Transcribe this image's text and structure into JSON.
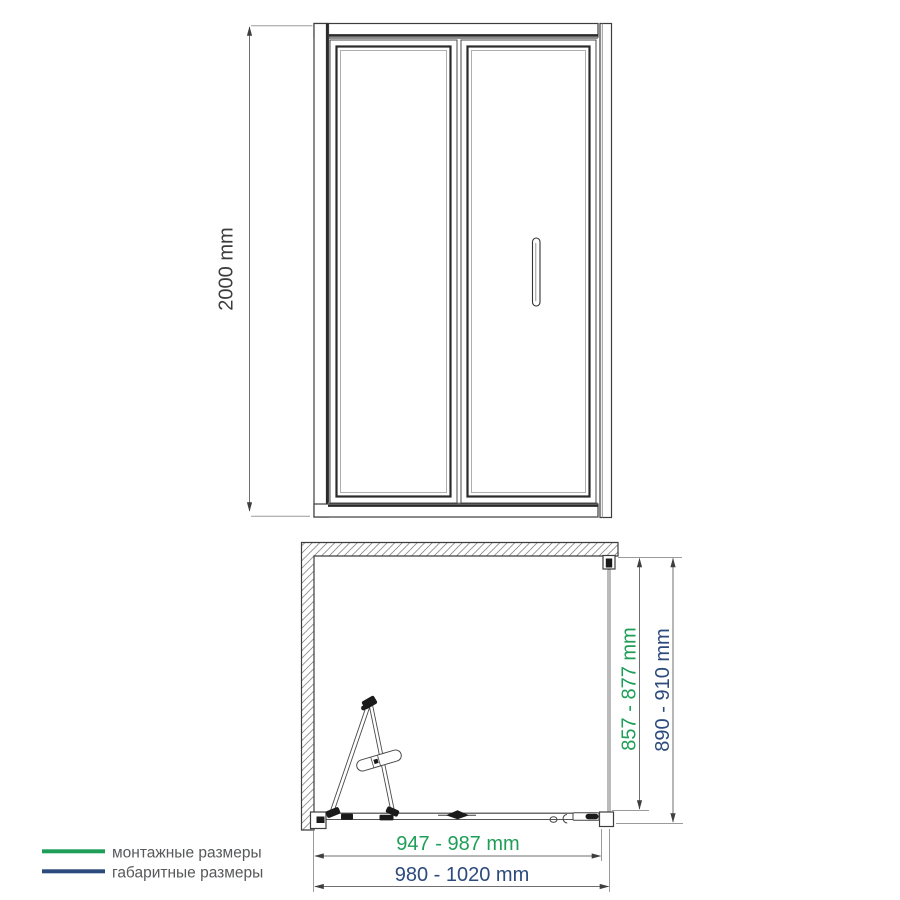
{
  "drawing": {
    "front_view": {
      "height": "2000 mm"
    },
    "plan_view": {
      "installation_depth": "857 - 877 mm",
      "overall_depth": "890 - 910 mm",
      "installation_width": "947 - 987 mm",
      "overall_width": "980 - 1020 mm"
    }
  },
  "legend": {
    "items": [
      {
        "label": "монтажные размеры"
      },
      {
        "label": "габаритные размеры"
      }
    ]
  },
  "colors": {
    "installation": "#1f9e58",
    "overall": "#2c4a7c",
    "drawing_line": "#3d3d3d",
    "legend_text": "#57585a"
  }
}
